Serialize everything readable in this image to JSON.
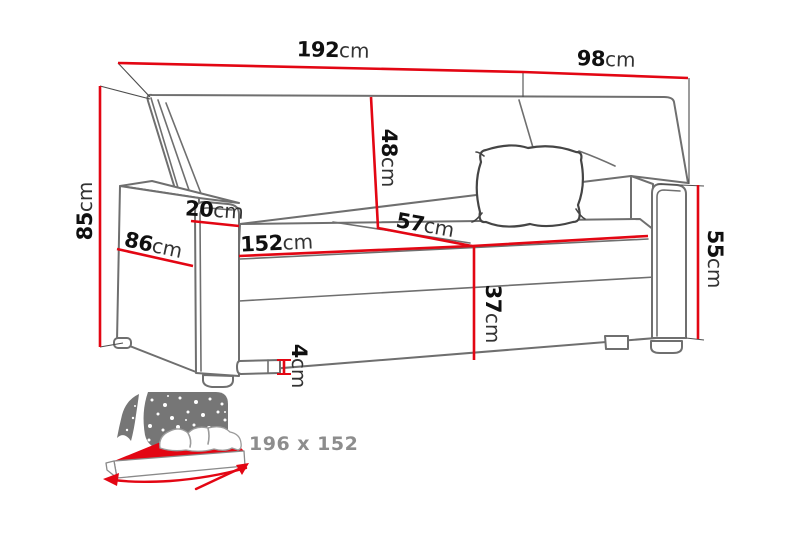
{
  "colors": {
    "dimension_red": "#e30613",
    "line_gray": "#6f6f6f",
    "icon_gray": "#767676",
    "size_text_gray": "#8d8d8d"
  },
  "dimensions": {
    "total_width": {
      "value": "192",
      "unit": "cm"
    },
    "total_depth": {
      "value": "98",
      "unit": "cm"
    },
    "total_height": {
      "value": "85",
      "unit": "cm"
    },
    "armrest_depth": {
      "value": "86",
      "unit": "cm"
    },
    "armrest_width": {
      "value": "20",
      "unit": "cm"
    },
    "backrest_height": {
      "value": "48",
      "unit": "cm"
    },
    "seat_width": {
      "value": "152",
      "unit": "cm"
    },
    "seat_depth": {
      "value": "57",
      "unit": "cm"
    },
    "seat_height": {
      "value": "37",
      "unit": "cm"
    },
    "leg_height": {
      "value": "4",
      "unit": "cm"
    },
    "armrest_height": {
      "value": "55",
      "unit": "cm"
    }
  },
  "bed_icon": {
    "sleeping_area_label": "196 x 152"
  }
}
